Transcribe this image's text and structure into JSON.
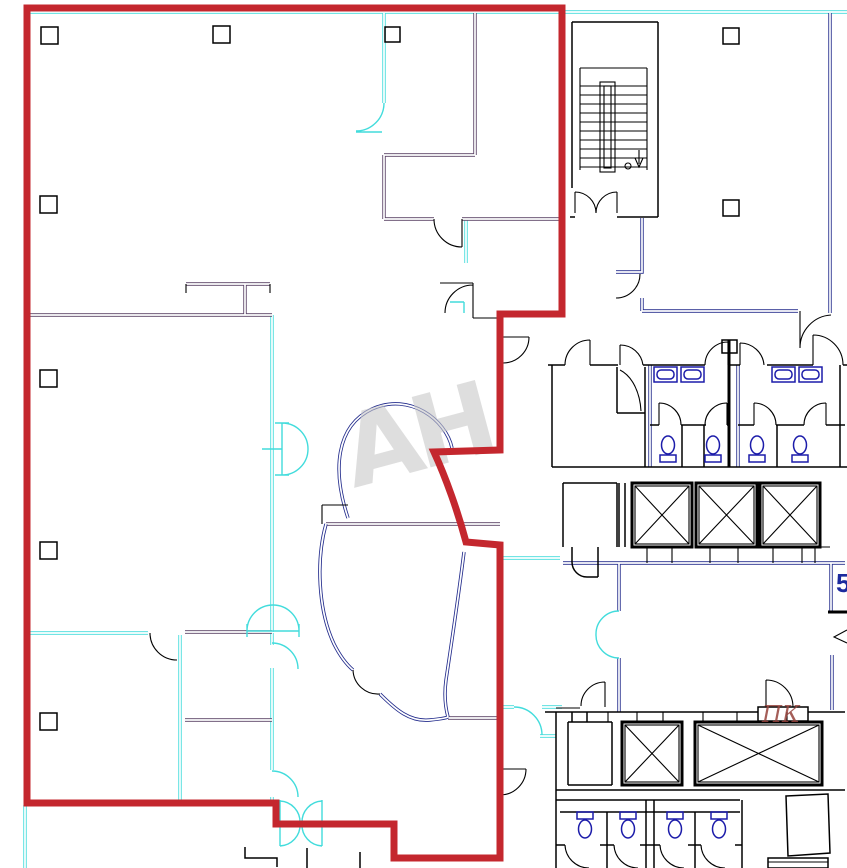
{
  "labels": {
    "watermark": "AH",
    "fire_hose_cabinet": "ПК",
    "unit_number_partial": "5"
  },
  "colors": {
    "boundary_red": "#c4272e",
    "wall_cyan": "#42dcdc",
    "wall_blue": "#232c8c",
    "wall_purple": "#584064",
    "wall_black": "#000000",
    "fixture_blue": "#1c1caa",
    "watermark_gray": "#c9c9c9",
    "label_darkred": "#96423c",
    "label_blue": "#1c2a9e"
  },
  "icons": {
    "column-icon": "small square structural column",
    "door-arc-icon": "quarter-circle door swing",
    "double-door-icon": "butterfly double-leaf door arcs",
    "half-door-icon": "semicircle door leaf",
    "staircase-icon": "treads with center stringer, down arrow and circle",
    "elevator-shaft-icon": "rectangle with X cross",
    "toilet-icon": "bowl ellipse with tank",
    "sink-icon": "basin rectangle with rounded inner bowl",
    "fire-hose-cabinet-icon": "wall box labeled ПК",
    "section-arrow-icon": "arrowhead mark at right edge"
  }
}
